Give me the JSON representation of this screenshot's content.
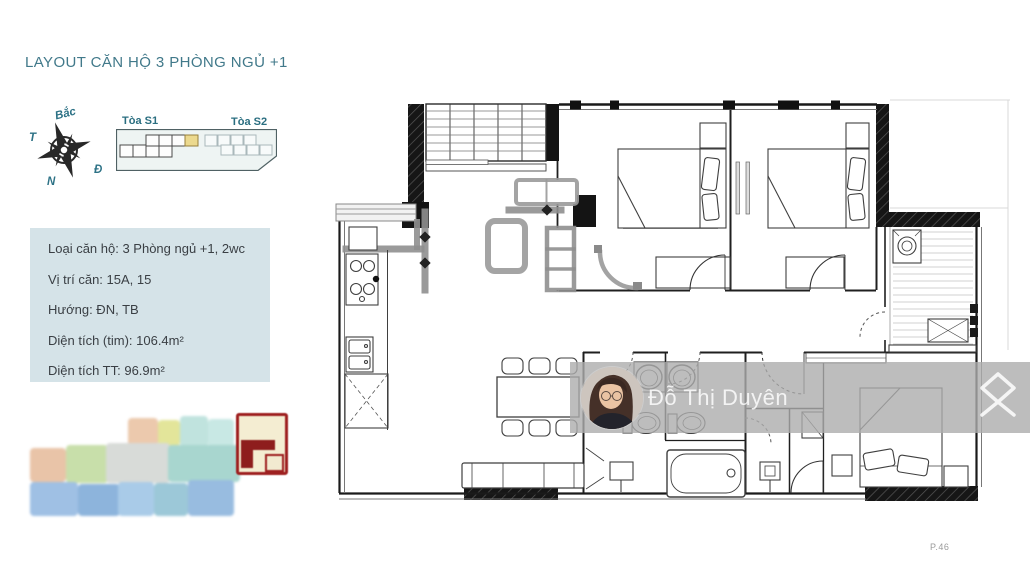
{
  "header": {
    "title": "LAYOUT CĂN HỘ 3 PHÒNG NGỦ +1"
  },
  "compass": {
    "north_label": "Bắc",
    "west_label": "T",
    "east_label": "Đ",
    "south_label": "N"
  },
  "site_map": {
    "tower_s1_label": "Tòa S1",
    "tower_s2_label": "Tòa S2"
  },
  "info_box": {
    "rows": [
      "Loại căn hộ: 3 Phòng ngủ +1, 2wc",
      "Vị trí căn: 15A, 15",
      "Hướng: ĐN, TB",
      "Diện tích (tim): 106.4m²",
      "Diện tích TT: 96.9m²"
    ]
  },
  "watermark": {
    "display_name": "Đỗ Thị Duyên"
  },
  "footer": {
    "page_number": "P.46"
  },
  "colors": {
    "accent_teal": "#41798a",
    "info_box_bg": "#d5e3e8",
    "unit_highlight_yellow": "#ecd98e",
    "selected_unit_red": "#9e2020",
    "watermark_band_gray": "#acacac"
  }
}
